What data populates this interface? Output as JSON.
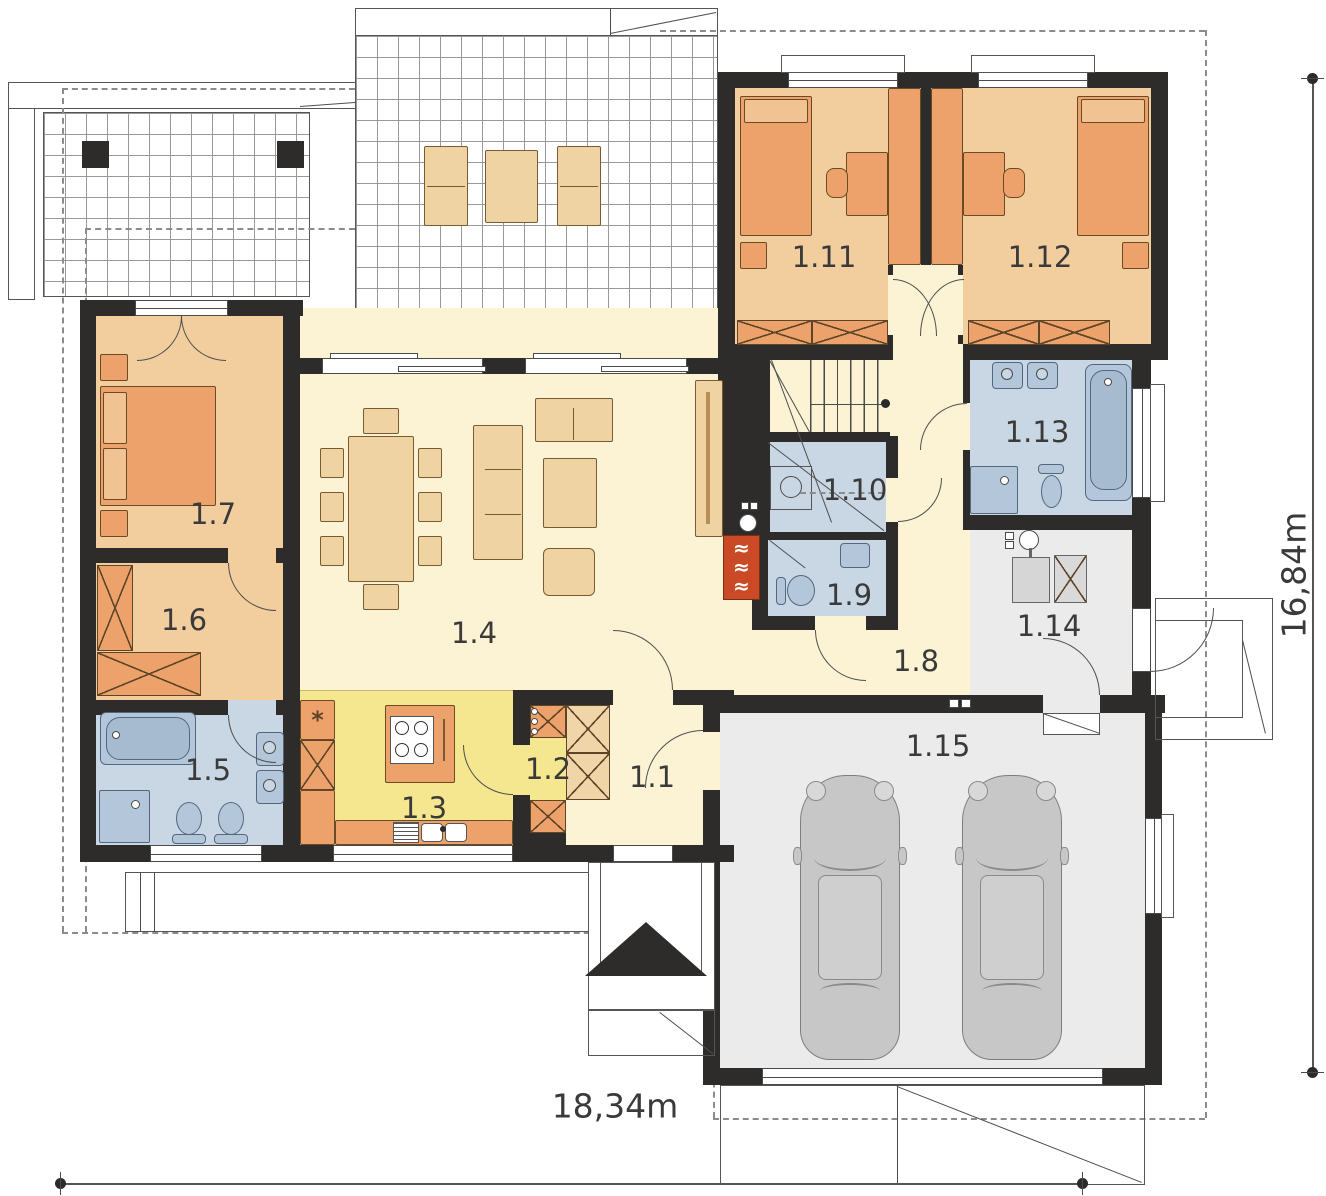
{
  "type": "architectural-floor-plan",
  "rooms": [
    {
      "label": "1.1"
    },
    {
      "label": "1.2"
    },
    {
      "label": "1.3"
    },
    {
      "label": "1.4"
    },
    {
      "label": "1.5"
    },
    {
      "label": "1.6"
    },
    {
      "label": "1.7"
    },
    {
      "label": "1.8"
    },
    {
      "label": "1.9"
    },
    {
      "label": "1.10"
    },
    {
      "label": "1.11"
    },
    {
      "label": "1.12"
    },
    {
      "label": "1.13"
    },
    {
      "label": "1.14"
    },
    {
      "label": "1.15"
    }
  ],
  "dimensions": {
    "width_label": "18,34m",
    "height_label": "16,84m"
  },
  "symbols": {
    "fridge_mark": "*",
    "fireplace_wave": "≈"
  },
  "colors": {
    "wall": "#2e2c2a",
    "floor_main": "#fbf3d4",
    "floor_kitchen": "#f5e690",
    "floor_bedroom": "#f2cd9e",
    "floor_bath": "#c9d6e3",
    "floor_garage": "#ebebeb",
    "furniture_orange": "#eca26a",
    "furniture_beige": "#f0d5a8",
    "fireplace": "#c94a24",
    "fixture_blue": "#b4c6d9",
    "car": "#c7c7c7"
  }
}
